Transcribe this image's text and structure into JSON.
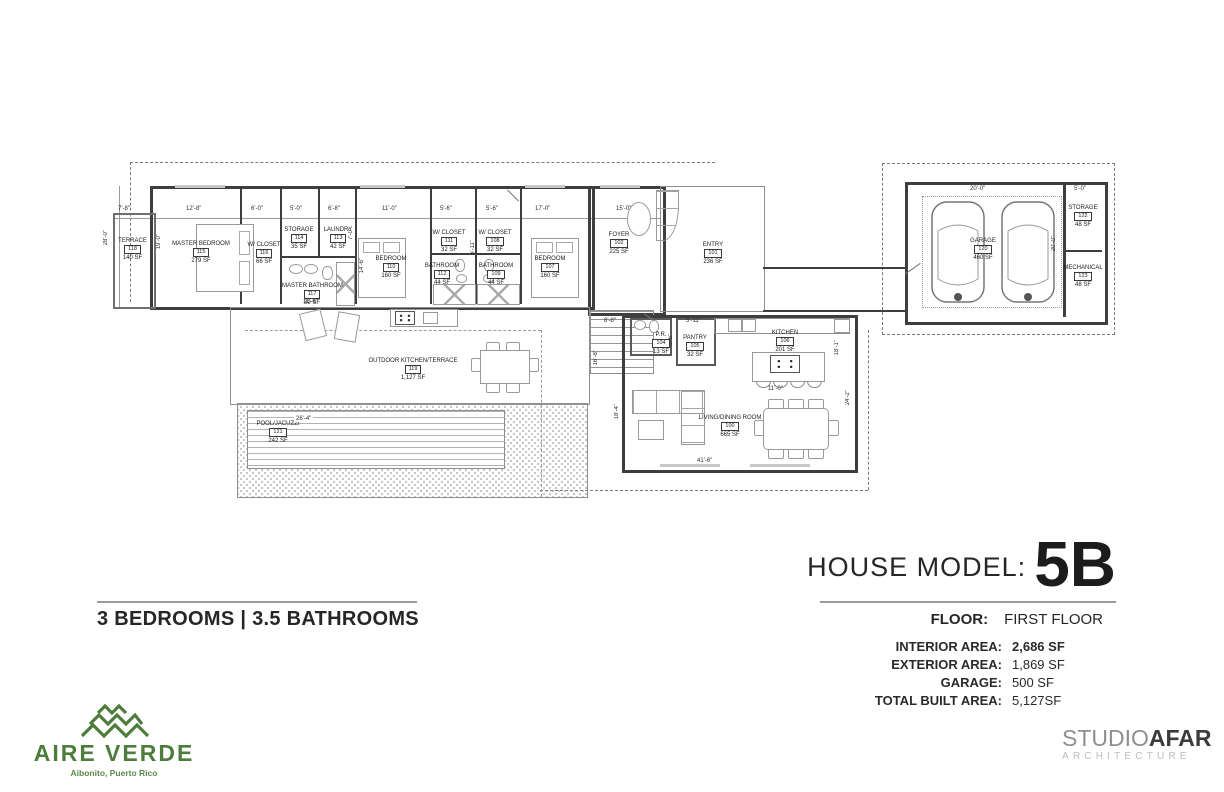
{
  "title": {
    "label": "HOUSE MODEL:",
    "model": "5B"
  },
  "floor": {
    "label": "FLOOR:",
    "value": "FIRST FLOOR"
  },
  "summary": {
    "bedrooms_bathrooms": "3 BEDROOMS | 3.5 BATHROOMS"
  },
  "areas": [
    {
      "label": "INTERIOR AREA:",
      "value": "2,686 SF"
    },
    {
      "label": "EXTERIOR AREA:",
      "value": "1,869 SF"
    },
    {
      "label": "GARAGE:",
      "value": "500 SF"
    },
    {
      "label": "TOTAL BUILT AREA:",
      "value": "5,127SF"
    }
  ],
  "brand": {
    "name": "AIRE VERDE",
    "location": "Aibonito, Puerto Rico",
    "accent_green": "#4e7c3c"
  },
  "studio": {
    "word1": "STUDIO",
    "word2": "AFAR",
    "subtitle": "ARCHITECTURE",
    "gray": "#8f8f8f",
    "dark": "#3b3b3b"
  },
  "plan": {
    "rooms": [
      {
        "name": "TERRACE",
        "num": "118",
        "area": "140 SF"
      },
      {
        "name": "MASTER BEDROOM",
        "num": "115",
        "area": "279 SF"
      },
      {
        "name": "W/ CLOSET",
        "num": "116",
        "area": "66 SF"
      },
      {
        "name": "STORAGE",
        "num": "114",
        "area": "35 SF"
      },
      {
        "name": "LAUNDRY",
        "num": "113",
        "area": "42 SF"
      },
      {
        "name": "MASTER BATHROOM",
        "num": "117",
        "area": "89 SF"
      },
      {
        "name": "BEDROOM",
        "num": "110",
        "area": "160 SF"
      },
      {
        "name": "W/ CLOSET",
        "num": "111",
        "area": "32 SF"
      },
      {
        "name": "BATHROOM",
        "num": "112",
        "area": "44 SF"
      },
      {
        "name": "W/ CLOSET",
        "num": "108",
        "area": "32 SF"
      },
      {
        "name": "BATHROOM",
        "num": "109",
        "area": "44 SF"
      },
      {
        "name": "BEDROOM",
        "num": "107",
        "area": "160 SF"
      },
      {
        "name": "FOYER",
        "num": "102",
        "area": "225 SF"
      },
      {
        "name": "ENTRY",
        "num": "101",
        "area": "236 SF"
      },
      {
        "name": "P.R.",
        "num": "104",
        "area": "13 SF"
      },
      {
        "name": "PANTRY",
        "num": "105",
        "area": "32 SF"
      },
      {
        "name": "KITCHEN",
        "num": "106",
        "area": "201 SF"
      },
      {
        "name": "LIVING/DINING ROOM",
        "num": "100",
        "area": "665 SF"
      },
      {
        "name": "OUTDOOR KITCHEN/TERRACE",
        "num": "119",
        "area": "1,127 SF"
      },
      {
        "name": "POOL/JACUZZI",
        "num": "121",
        "area": "242 SF"
      },
      {
        "name": "GARAGE",
        "num": "120",
        "area": "460 SF"
      },
      {
        "name": "STORAGE",
        "num": "122",
        "area": "48 SF"
      },
      {
        "name": "MECHANICAL",
        "num": "123",
        "area": "48 SF"
      }
    ],
    "dims": [
      "7'-8\"",
      "12'-8\"",
      "6'-0\"",
      "5'-0\"",
      "6'-8\"",
      "11'-0\"",
      "5'-6\"",
      "5'-6\"",
      "17'-0\"",
      "15'-0\"",
      "28'-0\"",
      "19'-0\"",
      "7'-0\"",
      "14'-6\"",
      "11'-6\"",
      "5'-11\"",
      "8'-8\"",
      "5'-11\"",
      "5'-6\"",
      "18'-1\"",
      "11'-0\"",
      "24'-2\"",
      "18'-4\"",
      "41'-6\"",
      "16'-8\"",
      "26'-4\"",
      "20'-0\"",
      "5'-0\"",
      "20'-0\""
    ]
  }
}
